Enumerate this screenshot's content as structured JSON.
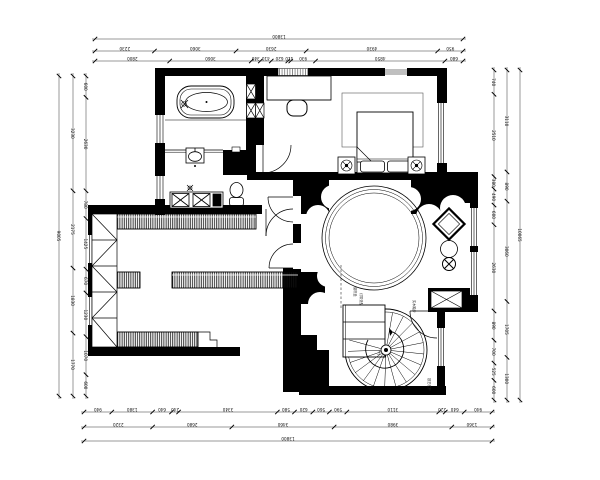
{
  "drawing": {
    "type": "residential-floor-plan",
    "background": "#ffffff",
    "line_color": "#000000",
    "wall_color": "#000000"
  },
  "dimensions": {
    "top_rows": [
      {
        "values": [
          "13800"
        ]
      },
      {
        "values": [
          "2230",
          "3060",
          "2630",
          "4930",
          "950"
        ]
      },
      {
        "values": [
          "2800",
          "3060",
          "340",
          "410",
          "620",
          "110",
          "930",
          "4850",
          "680"
        ]
      }
    ],
    "bottom_rows": [
      {
        "values": [
          "940",
          "1380",
          "640",
          "240",
          "3340",
          "580",
          "620",
          "560",
          "590",
          "3110",
          "220",
          "640",
          "940"
        ]
      },
      {
        "values": [
          "2320",
          "2680",
          "3460",
          "3980",
          "1360"
        ]
      },
      {
        "values": [
          "13800"
        ]
      }
    ],
    "left_rows": [
      {
        "values": [
          "9005"
        ]
      },
      {
        "values": [
          "3230",
          "2175",
          "1830",
          "1770"
        ]
      },
      {
        "values": [
          "600",
          "2630",
          "780",
          "1425",
          "670",
          "1230",
          "1070",
          "600"
        ]
      }
    ],
    "right_rows": [
      {
        "values": [
          "740",
          "2510",
          "380",
          "490",
          "600",
          "2630",
          "890",
          "700",
          "525",
          "600"
        ]
      },
      {
        "values": [
          "3110",
          "890",
          "3060",
          "1705",
          "1300"
        ]
      },
      {
        "values": [
          "10065"
        ]
      }
    ]
  },
  "annotations": {
    "curtain_note": "窗帘盒",
    "light_note": "灯带造型",
    "stair_note_top": "实木踏步",
    "stair_note_side": "铁艺栏杆",
    "stair_up": "上"
  }
}
